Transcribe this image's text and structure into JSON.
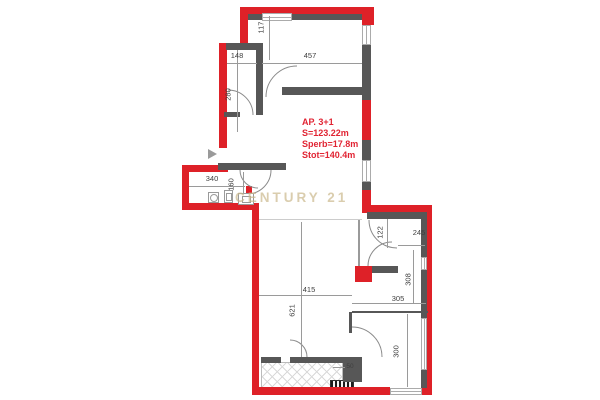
{
  "watermark": "CENTURY 21",
  "info": {
    "line1": "AP. 3+1",
    "line2": "S=123.22m",
    "line3": "Sperb=17.8m",
    "line4": "Stot=140.4m"
  },
  "dims": {
    "d117": "117",
    "d148": "148",
    "d457": "457",
    "d280": "280",
    "d340": "340",
    "d160": "160",
    "d122": "122",
    "d245": "245",
    "d308": "308",
    "d305": "305",
    "d300": "300",
    "d415": "415",
    "d621": "621",
    "d50": "50"
  },
  "colors": {
    "wall_red": "#de2128",
    "wall_gray": "#575757",
    "watermark_gold": "#cbb88c",
    "info_text_red": "#e12433"
  }
}
